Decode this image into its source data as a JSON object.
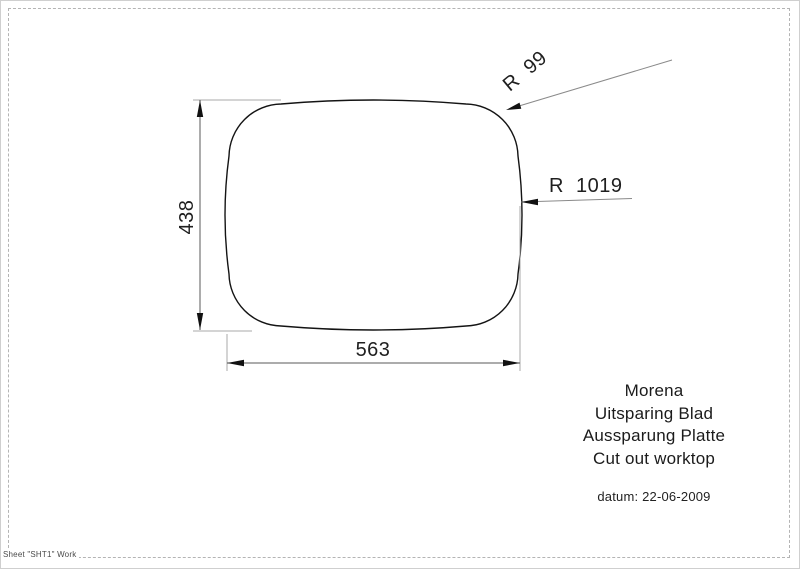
{
  "drawing": {
    "dim_height": "438",
    "dim_width": "563",
    "radius_corner": "R  99",
    "radius_side": "R  1019",
    "shape": "rounded-rectangle cut-out outline",
    "units_values": {
      "height": 438,
      "width": 563,
      "corner_radius": 99,
      "side_radius": 1019
    }
  },
  "title_block": {
    "lines": [
      "Morena",
      "Uitsparing Blad",
      "Aussparung Platte",
      "Cut out worktop"
    ],
    "datum": "datum: 22-06-2009"
  },
  "sheet": {
    "label": "Sheet \"SHT1\" Work"
  },
  "colors": {
    "outline": "#141414",
    "dimension_line": "#5a5a5a",
    "extension_line": "#a8a8a8",
    "arrow": "#111111",
    "frame_dash": "#b4b4b4"
  }
}
